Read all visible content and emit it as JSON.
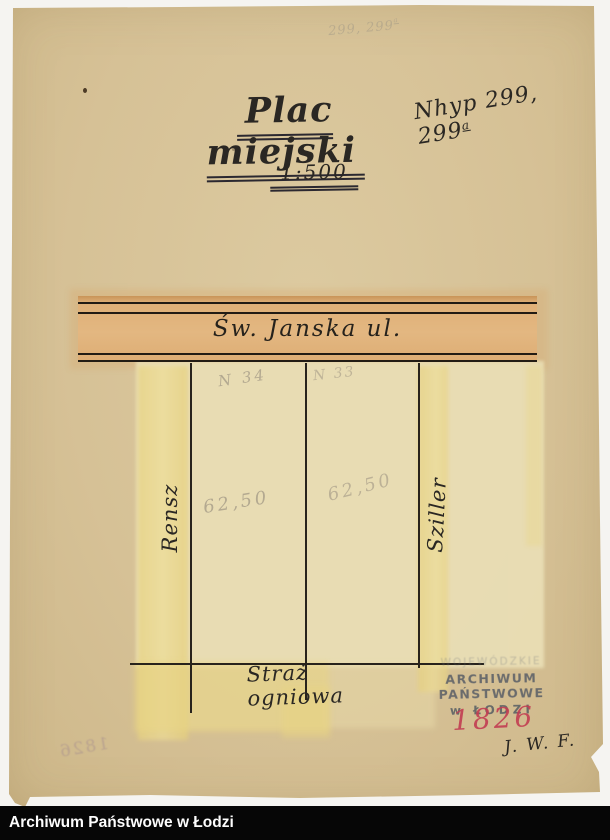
{
  "caption_bar": {
    "text": "Archiwum Państwowe w Łodzi"
  },
  "doc": {
    "pencil_note": {
      "main": "299, 299",
      "sup": "a"
    },
    "title": "Plac miejski",
    "hyp_note": {
      "main": "Nhyp 299, 299",
      "sup": "a"
    },
    "scale": "1:500",
    "plan": {
      "street": "Św. Janska ul.",
      "plots": [
        {
          "number": "N 34",
          "measure": "62,50"
        },
        {
          "number": "N 33",
          "measure": "62,50"
        }
      ],
      "owner_left": "Rensz",
      "owner_right": "Sziller",
      "bottom": "Straż ogniowa"
    },
    "stamp": {
      "line1": "WOJEWÓDZKIE",
      "line2": "ARCHIWUM PAŃSTWOWE",
      "line3": "w ŁODZI"
    },
    "red_number": "1826",
    "bleedthrough_number": "1826",
    "initials": "J. W. F."
  },
  "colors": {
    "paper": "#d6c196",
    "plan_ground": "#e9deb5",
    "wash_yellow": "#e8d483",
    "street_band": "#e3b781",
    "ink": "#2a2723",
    "pencil": "#a59b87",
    "stamp_gray": "#585d66",
    "red_accent": "#c23d52",
    "caption_bg": "#060606"
  }
}
